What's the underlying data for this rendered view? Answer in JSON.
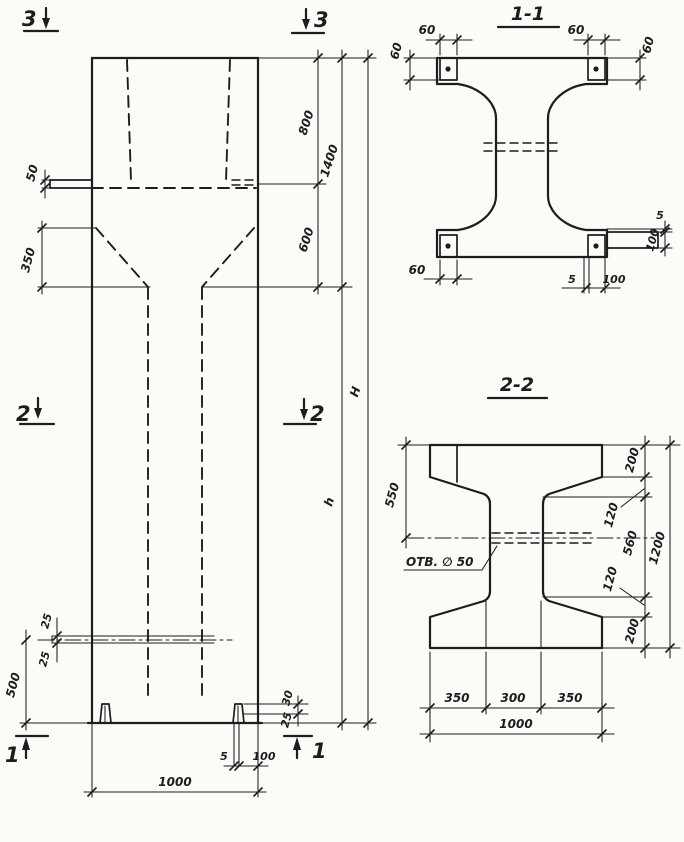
{
  "colors": {
    "paper": "#fcfbf7",
    "ink": "#1d1d1d"
  },
  "elevation": {
    "markers": {
      "s3_left": "3",
      "s3_right": "3",
      "s2_left": "2",
      "s2_right": "2",
      "s1_left": "1",
      "s1_right": "1"
    },
    "dims": {
      "ledge_offset": "50",
      "shoulder": "350",
      "cap_upper": "800",
      "cap_total": "1400",
      "cap_lower": "600",
      "total_height": "H",
      "shaft_height": "h",
      "hole_off_top": "25",
      "hole_off_bottom": "25",
      "hole_to_base": "500",
      "rib_upper": "30",
      "rib_lower": "25",
      "base_plate_thk": "5",
      "base_plate_width": "100",
      "width": "1000"
    }
  },
  "section11": {
    "title": "1-1",
    "dims": {
      "anchor_tl": "60",
      "anchor_tr": "60",
      "edge_left": "60",
      "edge_right": "60",
      "anchor_bl": "60",
      "plate_thk": "5",
      "plate_width": "100",
      "strip_offset": "5",
      "strip_height": "100"
    }
  },
  "section22": {
    "title": "2-2",
    "hole_label": "ОТВ. ∅ 50",
    "dims": {
      "flange_to_axis": "550",
      "flange_top": "200",
      "haunch_top": "120",
      "web_clear": "560",
      "haunch_bottom": "120",
      "flange_bottom": "200",
      "height": "1200",
      "w_left": "350",
      "w_mid": "300",
      "w_right": "350",
      "width": "1000"
    }
  }
}
